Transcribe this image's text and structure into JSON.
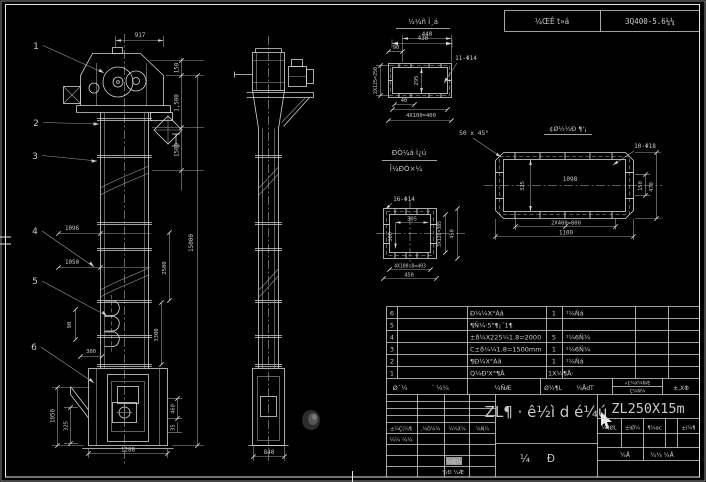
{
  "colors": {
    "background": "#000000",
    "line": "#d4d4d4",
    "model_text": "#b8b8b8",
    "highlight_cell": "#9a9a9a"
  },
  "stamp": {
    "note": "½¼ñ Ï¸á",
    "dim": "430"
  },
  "header": {
    "field": "¼ŒÊ t»á",
    "number": "3Q400-5.6¼¼"
  },
  "front": {
    "c1": "1",
    "c2": "2",
    "c3": "3",
    "c4": "4",
    "c5": "5",
    "c6": "6",
    "w_top": "917",
    "h1": "150",
    "h2": "1,500",
    "h3": "1500",
    "total": "15000",
    "s1": "1096",
    "s2": "1050",
    "s3": "2500",
    "s4": "3300",
    "b_pitch": "90",
    "b_proj": "300",
    "boot_h": "1050",
    "boot_d": "325",
    "boot_w": "1288",
    "r1": "460",
    "r2": "35"
  },
  "side": {
    "base": "840"
  },
  "detail_a": {
    "w": "440",
    "d90": "90",
    "holes": "11-Φ14",
    "left": "2X125=250",
    "inner": "295",
    "d40": "40",
    "bottom": "4X100=400",
    "chamfer": "50 x 45°"
  },
  "detail_b": {
    "title": "¢Ø½¼Ð ¶'¡",
    "holes": "10-Φ18",
    "inner": "1098",
    "left": "325",
    "r1": "150",
    "r2": "470",
    "b1": "2X400=800",
    "b2": "1100"
  },
  "detail_c": {
    "t1": "ÐÒ¼á Ì¿ú",
    "t2": "Î¼ÐÓ×¼",
    "holes": "16-Φ14",
    "iw": "305",
    "ih": "300",
    "r1": "3X128=385",
    "r2": "450",
    "b1": "4X100.8=403",
    "b2": "450"
  },
  "bom": {
    "rows": [
      {
        "no": "6",
        "name": "Ð¼¼X°Àâ",
        "qty": "1",
        "mat": "¹¼Ñá"
      },
      {
        "no": "5",
        "name": "¶Ñ¼·5\"¶¡´1¶",
        "qty": "",
        "mat": ""
      },
      {
        "no": "4",
        "name": "±ð¼X225¼1.8=2000",
        "qty": "5",
        "mat": "¹¼6Ñ¼"
      },
      {
        "no": "3",
        "name": "C±ð¼¼1.8=1500mm",
        "qty": "1",
        "mat": "¹¼6Ñ¼"
      },
      {
        "no": "2",
        "name": "¶Ð¼X°Àâ",
        "qty": "1",
        "mat": "¹¼Ñá"
      },
      {
        "no": "1",
        "name": "Q¼Ð'X°¶Å",
        "qty": "1X¼¶Å·",
        "mat": ""
      }
    ],
    "h": {
      "c1a": "Ø´¼",
      "c1b": "´ ¼¼",
      "c2": "¼ÑÆ",
      "c3a": "Ø¼¶L",
      "c3b": "¼ÅdT",
      "c4a": "«£¼X¼ÑÆ",
      "c4b": "Ç¼Ñ¼",
      "c5": "±,XΦ"
    }
  },
  "tb": {
    "title": "ZL¶ · ê½ì d é¼ú",
    "model": "ZL250X15m",
    "l1": "±¼Ç(¼¶",
    "l2": ",¼Ò¼¼",
    "l3": "¼¼X¼",
    "l4": "¼Ñ¼",
    "design": "¼¼ ¼¼",
    "check": "¼Ð ¼Æ",
    "stamp_cell": "¼Æ¼",
    "s1": "¼¶ØL",
    "s2": "±ìØ¼",
    "s3": "¶¼ac",
    "s4": "±ì¼¶",
    "sheet1": "¼Å",
    "sheet2": "¼¼  ¼Å",
    "g1": "¼",
    "g2": "Ð"
  }
}
